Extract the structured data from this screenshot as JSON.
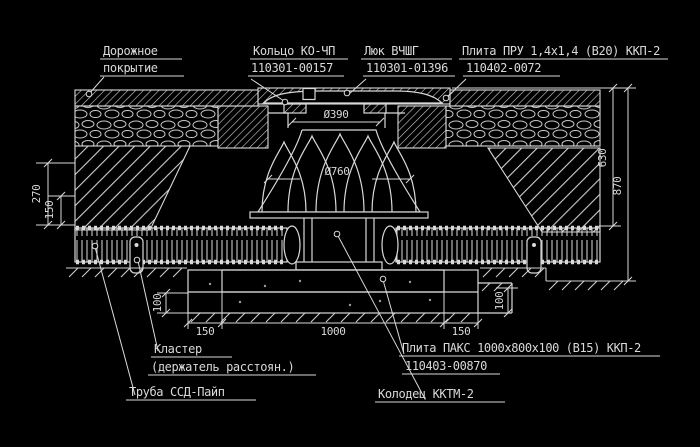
{
  "drawing": {
    "type": "engineering-cross-section",
    "colors": {
      "background": "#000000",
      "line": "#d9d9d9"
    },
    "annotations": {
      "road_surface": {
        "line1": "Дорожное",
        "line2": "покрытие"
      },
      "ring": {
        "line1": "Кольцо КО-ЧП",
        "line2": "110301-00157"
      },
      "hatch_cover": {
        "line1": "Люк ВЧШГ",
        "line2": "110301-01396"
      },
      "slab_pru": {
        "line1": "Плита ПРУ 1,4х1,4 (В20) ККП-2",
        "line2": "110402-0072"
      },
      "cluster": {
        "line1": "Кластер",
        "line2": "(держатель расстоян.)"
      },
      "pipe": {
        "line1": "Труба ССД-Пайп"
      },
      "slab_paks": {
        "line1": "Плита ПАКС 1000х800х100 (В15) ККП-2",
        "line2": "110403-00870"
      },
      "well": {
        "line1": "Колодец ККТМ-2"
      }
    },
    "dimensions": {
      "neck_diameter": "Ø390",
      "cone_diameter": "Ø760",
      "left_depth": "270",
      "left_inner": "150",
      "right_upper": "630",
      "right_lower": "870",
      "base_left": "150",
      "base_center": "1000",
      "base_right": "150",
      "bedding_left": "100",
      "bedding_right": "100"
    }
  }
}
